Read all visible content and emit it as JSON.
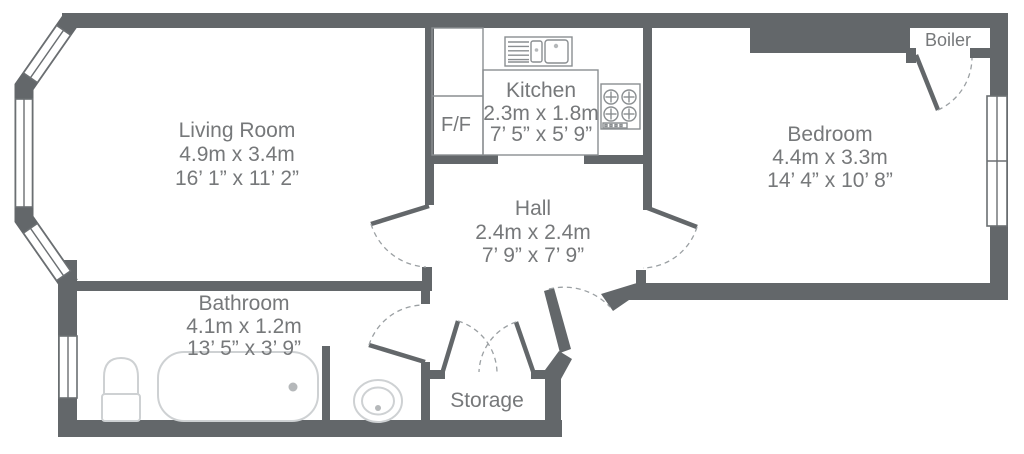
{
  "plan": {
    "rooms": [
      {
        "id": "living-room",
        "name": "Living Room",
        "metric": "4.9m x 3.4m",
        "imperial": "16’ 1” x 11’ 2”"
      },
      {
        "id": "kitchen",
        "name": "Kitchen",
        "metric": "2.3m x 1.8m",
        "imperial": "7’ 5” x 5’ 9”"
      },
      {
        "id": "hall",
        "name": "Hall",
        "metric": "2.4m x 2.4m",
        "imperial": "7’ 9” x 7’ 9”"
      },
      {
        "id": "bedroom",
        "name": "Bedroom",
        "metric": "4.4m x 3.3m",
        "imperial": "14’ 4” x 10’ 8”"
      },
      {
        "id": "bathroom",
        "name": "Bathroom",
        "metric": "4.1m x 1.2m",
        "imperial": "13’ 5” x 3’ 9”"
      }
    ],
    "areas": {
      "storage": "Storage",
      "boiler": "Boiler",
      "fridge_freezer": "F/F"
    },
    "fixtures": [
      "bay-window",
      "window",
      "sink-unit",
      "hob",
      "fridge-freezer-unit",
      "bath",
      "toilet",
      "basin",
      "door",
      "door-swing-arc"
    ],
    "colors": {
      "wall": "#63676a",
      "label_text": "#76787a",
      "fixture_outline": "#ced1d3",
      "counter_outline": "#8a8e91",
      "door_arc": "#9ba0a3",
      "background": "#ffffff"
    }
  }
}
